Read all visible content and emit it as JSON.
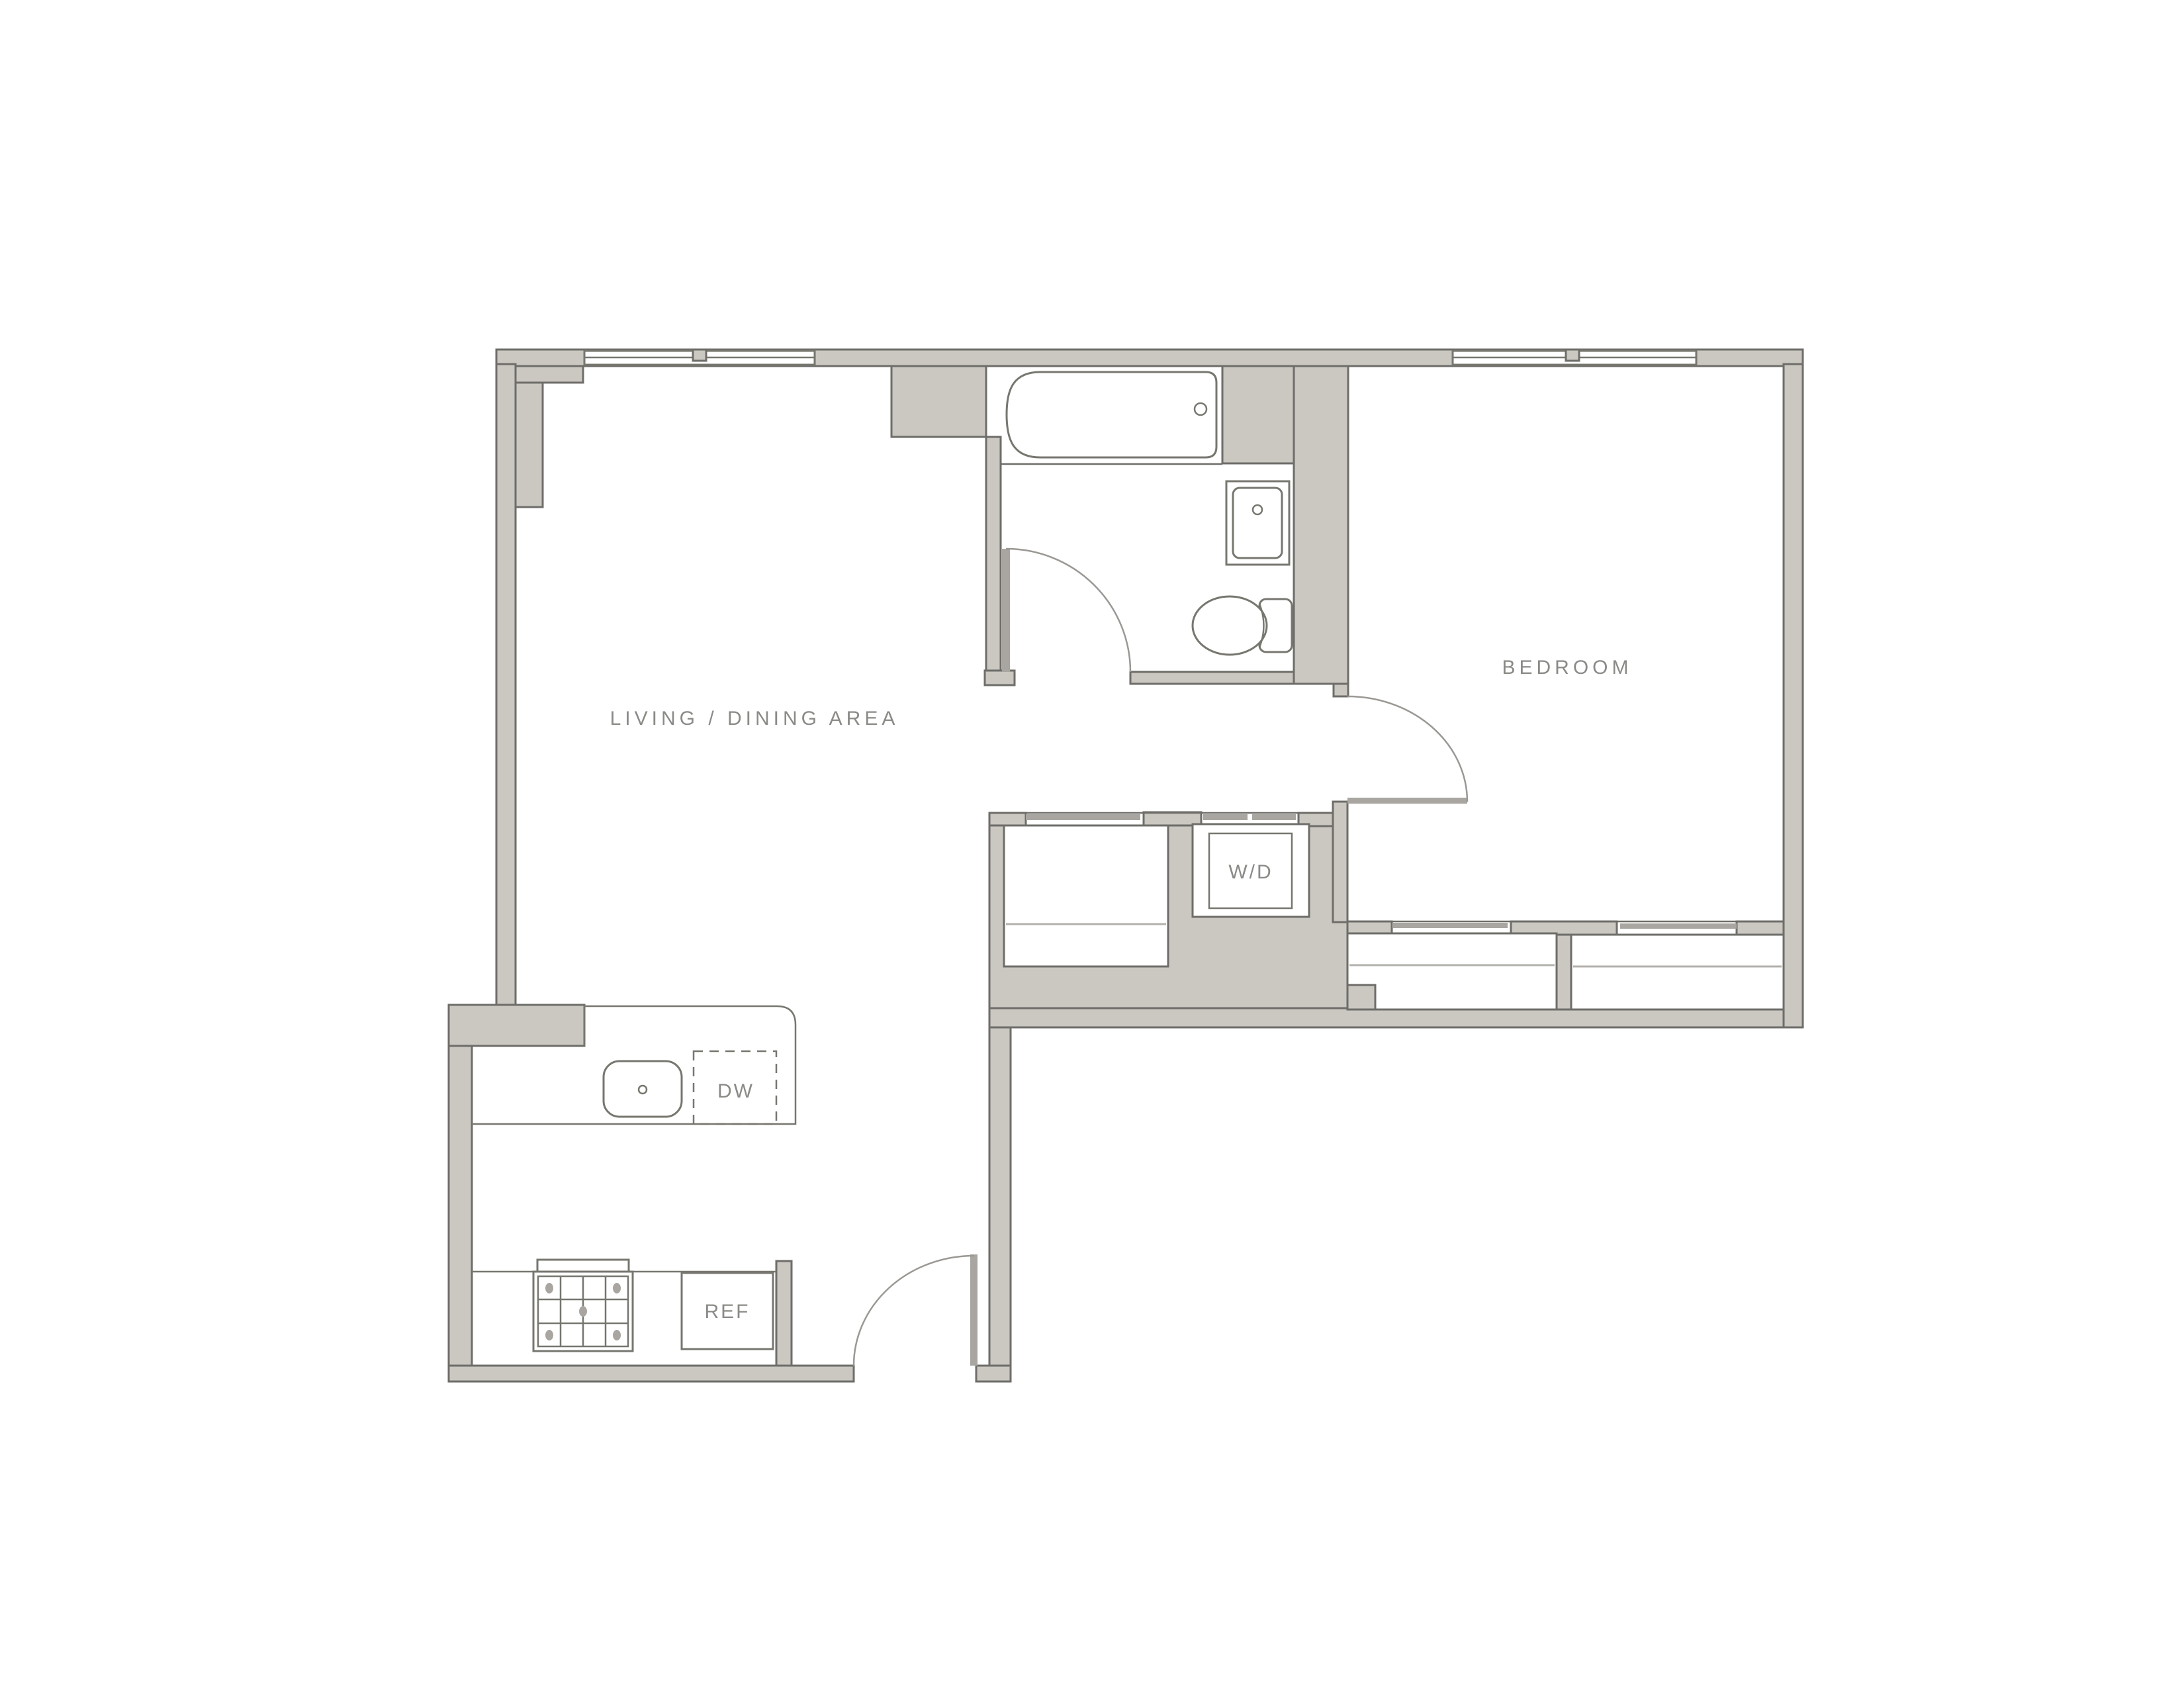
{
  "floor_plan": {
    "title": "one-bedroom apartment floor plan",
    "rooms": [
      {
        "id": "living-dining",
        "label": "LIVING / DINING AREA"
      },
      {
        "id": "bedroom",
        "label": "BEDROOM"
      }
    ],
    "fixtures": [
      {
        "id": "washer-dryer",
        "label": "W/D"
      },
      {
        "id": "dishwasher",
        "label": "DW"
      },
      {
        "id": "refrigerator",
        "label": "REF"
      },
      {
        "id": "bathtub",
        "label": ""
      },
      {
        "id": "toilet",
        "label": ""
      },
      {
        "id": "bathroom-sink",
        "label": ""
      },
      {
        "id": "kitchen-sink",
        "label": ""
      },
      {
        "id": "range",
        "label": ""
      }
    ],
    "features": [
      "bathroom",
      "entry-door",
      "bathroom-door",
      "bedroom-door",
      "hall-closet",
      "bedroom-closet-left",
      "bedroom-closet-right",
      "living-window",
      "bedroom-window"
    ],
    "colors": {
      "background": "#ffffff",
      "wall_fill": "#cbc7c1",
      "wall_outline": "#6e6d69",
      "door_leaf": "#a9a6a1",
      "swing_line": "#9b9894",
      "fixture_line": "#77766f",
      "shelf_line": "#b4b1ac",
      "label_text": "#8b8a86"
    }
  }
}
